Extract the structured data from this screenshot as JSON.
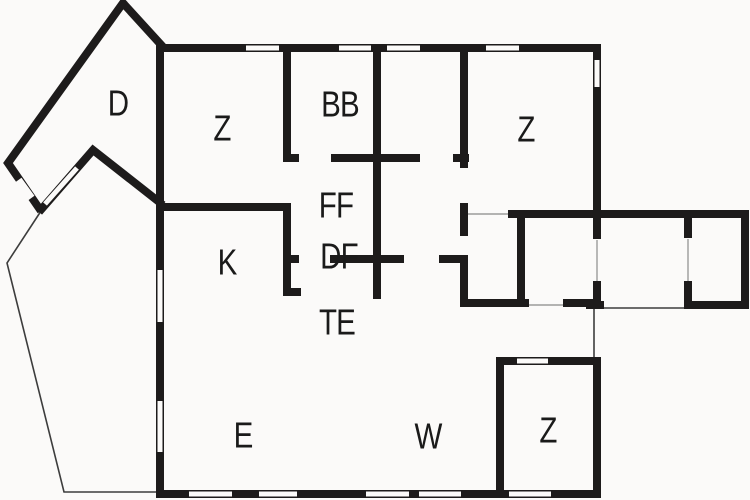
{
  "page": {
    "title": "Floor plan"
  },
  "palette": {
    "wall": "#1d1b1b",
    "background": "#fbfaf9",
    "thin_line": "#3d3d3d",
    "label": "#1a1a1a"
  },
  "rooms": [
    {
      "id": "d",
      "label": "D"
    },
    {
      "id": "z-top-left",
      "label": "Z"
    },
    {
      "id": "bb",
      "label": "BB"
    },
    {
      "id": "z-top-right",
      "label": "Z"
    },
    {
      "id": "ff",
      "label": "FF"
    },
    {
      "id": "k",
      "label": "K"
    },
    {
      "id": "df",
      "label": "DF"
    },
    {
      "id": "te",
      "label": "TE"
    },
    {
      "id": "e",
      "label": "E"
    },
    {
      "id": "w",
      "label": "W"
    },
    {
      "id": "z-bottom",
      "label": "Z"
    }
  ]
}
